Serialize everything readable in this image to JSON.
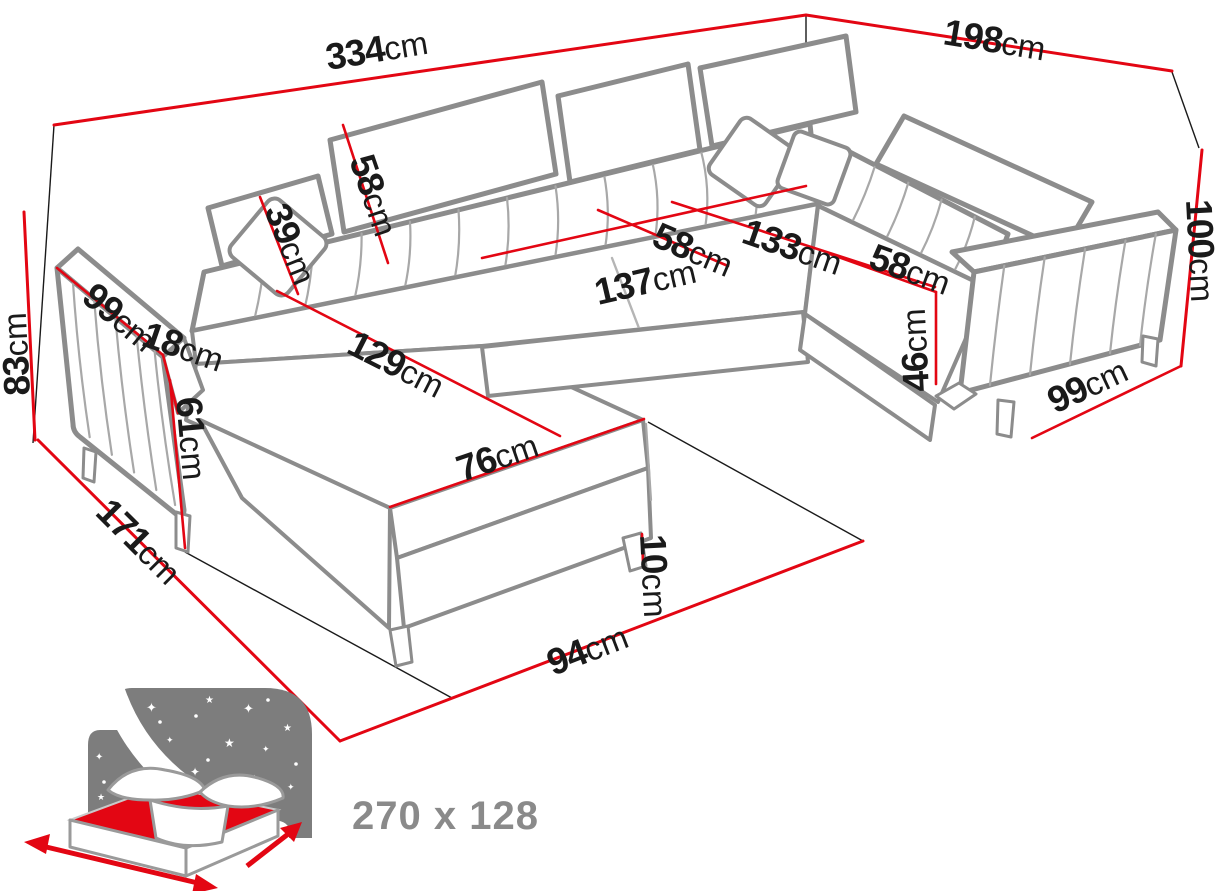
{
  "colors": {
    "dimension_red": "#e30613",
    "sofa_gray": "#8c8c8c",
    "text_black": "#1a1a1a",
    "icon_gray": "#7d7d7d"
  },
  "diagram": {
    "type": "furniture-dimension-diagram",
    "subject": "u-shaped-corner-sofa",
    "dimensions": [
      {
        "id": "total-width",
        "num": "334",
        "unit": "cm"
      },
      {
        "id": "total-depth-right",
        "num": "198",
        "unit": "cm"
      },
      {
        "id": "back-height-left",
        "num": "83",
        "unit": "cm"
      },
      {
        "id": "left-arm-length",
        "num": "99",
        "unit": "cm"
      },
      {
        "id": "arm-width",
        "num": "18",
        "unit": "cm"
      },
      {
        "id": "headrest-small-width",
        "num": "39",
        "unit": "cm"
      },
      {
        "id": "headrest-large-width",
        "num": "58",
        "unit": "cm"
      },
      {
        "id": "chaise-seat-length",
        "num": "129",
        "unit": "cm"
      },
      {
        "id": "chaise-front-height",
        "num": "61",
        "unit": "cm"
      },
      {
        "id": "chaise-width",
        "num": "76",
        "unit": "cm"
      },
      {
        "id": "middle-seat-length",
        "num": "137",
        "unit": "cm"
      },
      {
        "id": "middle-seat-depth",
        "num": "58",
        "unit": "cm"
      },
      {
        "id": "corner-seat-width",
        "num": "133",
        "unit": "cm"
      },
      {
        "id": "right-seat-depth",
        "num": "58",
        "unit": "cm"
      },
      {
        "id": "seat-height",
        "num": "46",
        "unit": "cm"
      },
      {
        "id": "back-height-right",
        "num": "100",
        "unit": "cm"
      },
      {
        "id": "right-arm-length",
        "num": "99",
        "unit": "cm"
      },
      {
        "id": "leg-height",
        "num": "10",
        "unit": "cm"
      },
      {
        "id": "footprint-depth-left",
        "num": "171",
        "unit": "cm"
      },
      {
        "id": "footprint-front",
        "num": "94",
        "unit": "cm"
      }
    ],
    "sleeping_area": {
      "label": "270 x 128"
    }
  }
}
